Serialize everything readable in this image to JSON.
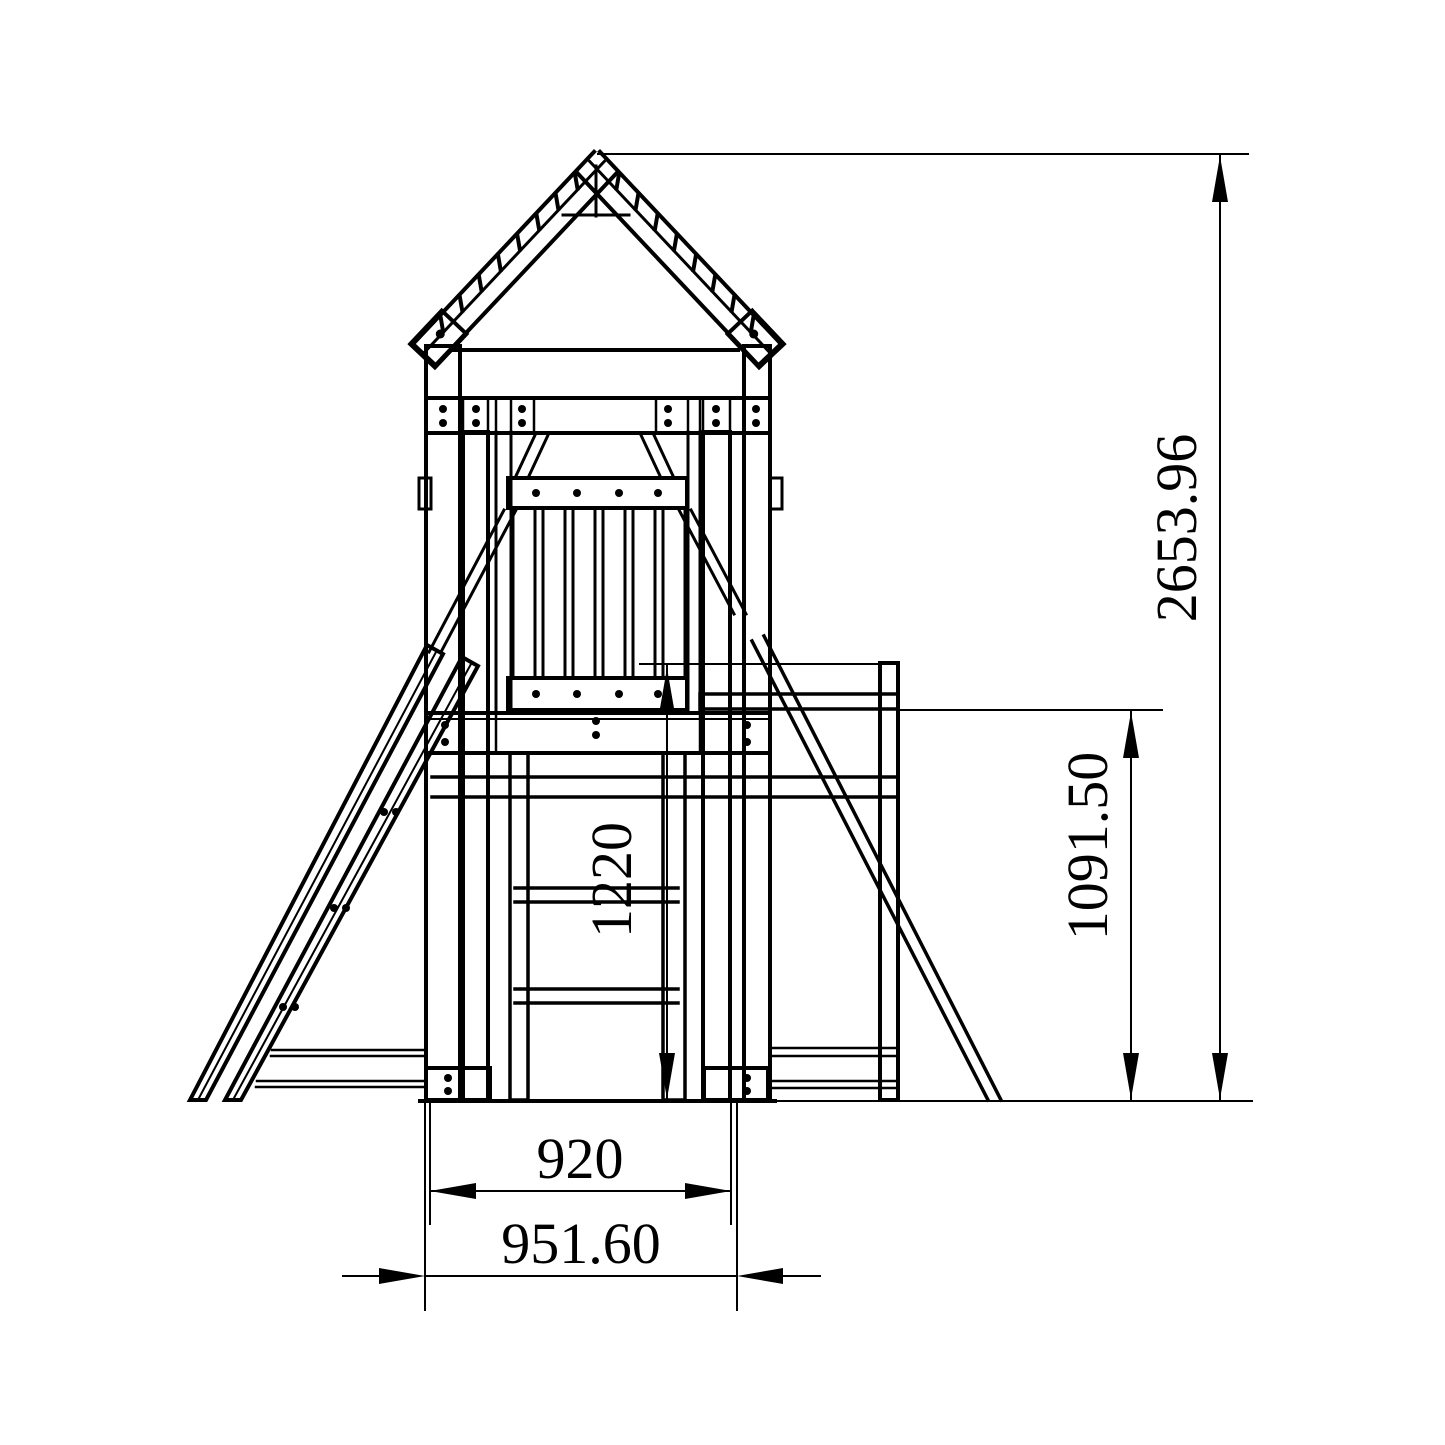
{
  "drawing": {
    "type": "technical-elevation",
    "subject": "playground-tower-front-view",
    "line_color": "#000000",
    "background_color": "#ffffff",
    "dimensions": {
      "overall_height": "2653.96",
      "beam_height": "1091.50",
      "platform_height": "1220",
      "base_inner_width": "920",
      "base_outer_width": "951.60"
    }
  }
}
